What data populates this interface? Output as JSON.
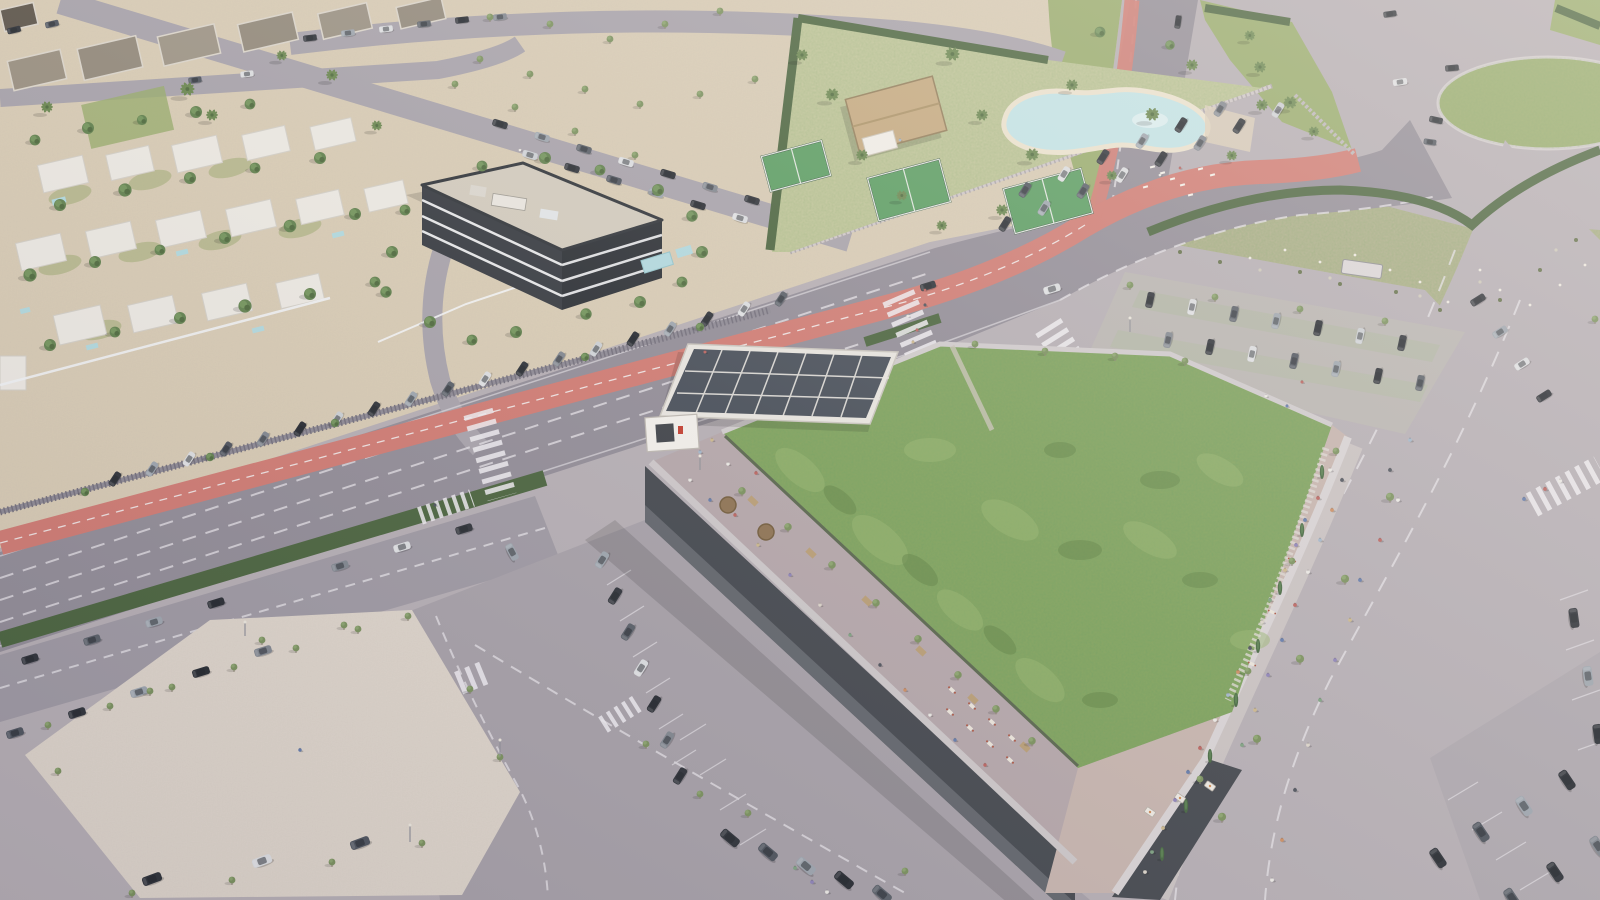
{
  "scene": {
    "type": "aerial-architectural-render",
    "time_of_day": "daytime, hazy sun from upper right",
    "description": "Bird's-eye 3D visualization of a commercial center with a planted green roof and crowded rooftop promenade, beside a main avenue with a red bike lane, a white-villa residential district, a dark modern apartment block, a leisure club with lagoon pool and padel courts, surface parking lots, an esplanade plaza, a grass roundabout and sheep-grazed scrubland.",
    "landmarks": [
      "commercial building with planted green roof",
      "rooftop promenade with pedestrians, stalls and cypress trees",
      "rooftop terrace with restaurant tables and round timber kiosks",
      "solar panel canopy over roof entrance",
      "main avenue with red two-way bike lane",
      "residential villa district with private pools",
      "dark glass apartment building",
      "leisure club with thatched pavilion, lagoon pool and padel courts",
      "esplanade plaza with young trees",
      "grass roundabout",
      "scrubland with grazing sheep",
      "surface parking lots full of cars"
    ]
  },
  "colors": {
    "road": "#8e8994",
    "road_light": "#b2abb1",
    "lane_line": "#e2dfe4",
    "bike_lane": "#cd776f",
    "hedge": "#46603a",
    "sand": "#d6c9b2",
    "plaza": "#dcd3c9",
    "lawn": "#94a868",
    "club_ground": "#bcc295",
    "scrub": "#a9ab85",
    "green_roof": "#7d9f59",
    "green_roof_dark": "#5c7f41",
    "green_roof_light": "#93b26b",
    "pool": "#bfe1e5",
    "beach": "#e9e0cc",
    "villa": "#e9e6e0",
    "dark_house": "#948a7b",
    "apt_facade": "#32363d",
    "apt_roof": "#cfc8bb",
    "slab": "#e3e4e6",
    "facade_dark": "#3f434a",
    "parapet": "#c9c4c6",
    "terrace": "#b1a3a7",
    "promenade": "#c3b1ab",
    "sidewalk": "#c6bfbf",
    "solar_panel": "#434a55",
    "solar_frame": "#e5e2dd",
    "thatch": "#c2a67c",
    "padel": "#569a5e",
    "car_dark": "#2a2e35",
    "car_silver": "#9aa2ab",
    "car_white": "#d9dbde",
    "tree_green": "#5d7d4a",
    "palm_green": "#66834c"
  },
  "inventory": {
    "cars_visible_approx": 120,
    "pedestrians_visible_approx": 85,
    "palm_trees_approx": 25,
    "street_trees_approx": 70,
    "padel_courts": 3,
    "private_pools_approx": 8,
    "lagoon_pool": 1,
    "crosswalks": 7,
    "roundabouts": 1,
    "sheep_approx": 12
  }
}
